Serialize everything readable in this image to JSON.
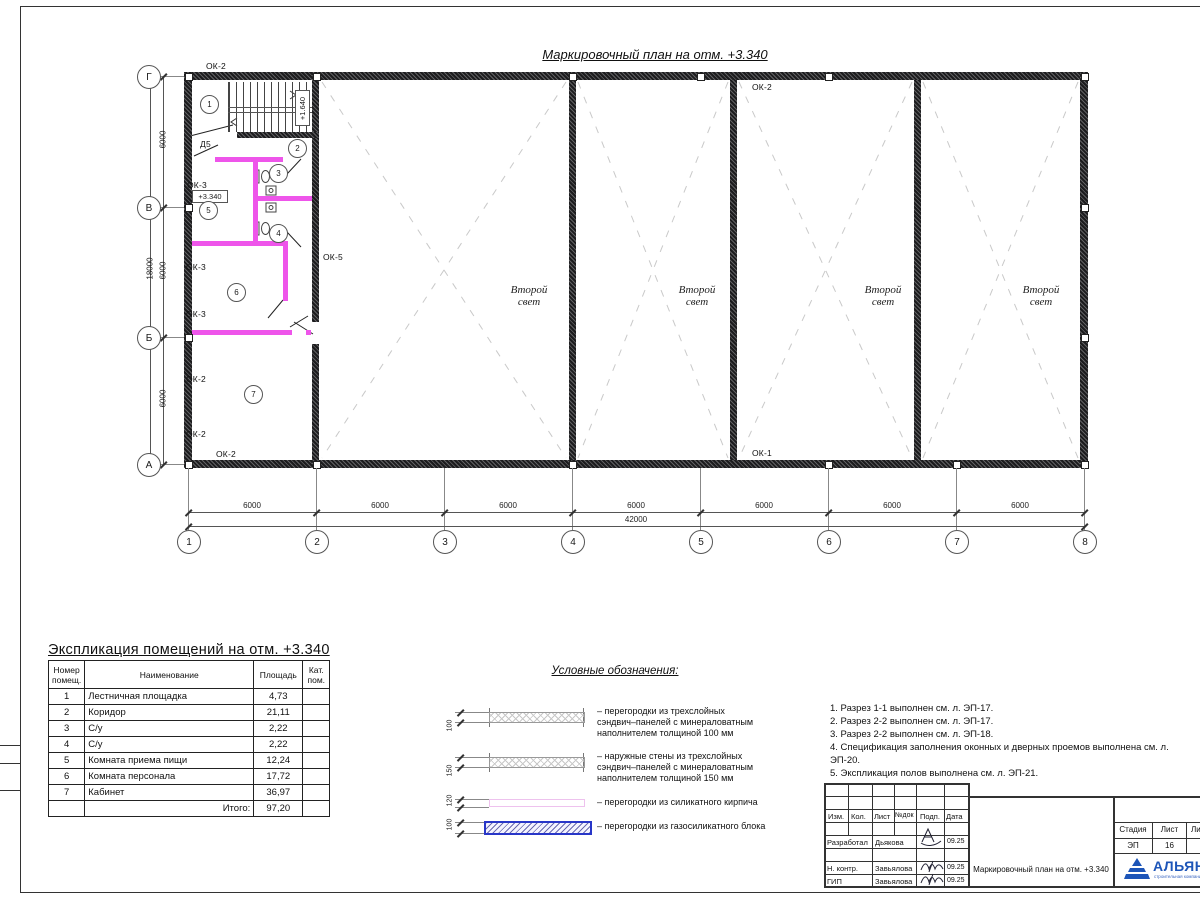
{
  "sheet_title": "Маркировочный план на отм. +3.340",
  "plan": {
    "marks": {
      "ok2_top_outside": "ОК-2",
      "ok2_top_inside": "ОК-2",
      "d5": "Д5",
      "ok3_room5": "ОК-3",
      "ok5": "ОК-5",
      "ok3_left_a": "ОК-3",
      "ok3_left_b": "ОК-3",
      "ok2_left_a": "ОК-2",
      "ok2_left_b": "ОК-2",
      "ok2_bottom": "ОК-2",
      "ok1_bottom": "ОК-1"
    },
    "levels": {
      "plan_level": "+3.340",
      "stair_level": "+1.640"
    },
    "rooms": [
      "1",
      "2",
      "3",
      "4",
      "5",
      "6",
      "7"
    ],
    "second_light": {
      "line1": "Второй",
      "line2": "свет"
    },
    "grid": {
      "cols": [
        "1",
        "2",
        "3",
        "4",
        "5",
        "6",
        "7",
        "8"
      ],
      "rows": [
        "Г",
        "В",
        "Б",
        "А"
      ]
    },
    "dims": {
      "bay": "6000",
      "total_width": "42000",
      "total_height": "18000"
    }
  },
  "room_schedule": {
    "title": "Экспликация помещений на отм. +3.340",
    "headers": {
      "num1": "Номер",
      "num2": "помещ.",
      "name": "Наименование",
      "area": "Площадь",
      "cat1": "Кат.",
      "cat2": "пом."
    },
    "rows": [
      {
        "num": "1",
        "name": "Лестничная площадка",
        "area": "4,73",
        "cat": ""
      },
      {
        "num": "2",
        "name": "Коридор",
        "area": "21,11",
        "cat": ""
      },
      {
        "num": "3",
        "name": "С/у",
        "area": "2,22",
        "cat": ""
      },
      {
        "num": "4",
        "name": "С/у",
        "area": "2,22",
        "cat": ""
      },
      {
        "num": "5",
        "name": "Комната приема пищи",
        "area": "12,24",
        "cat": ""
      },
      {
        "num": "6",
        "name": "Комната персонала",
        "area": "17,72",
        "cat": ""
      },
      {
        "num": "7",
        "name": "Кабинет",
        "area": "36,97",
        "cat": ""
      }
    ],
    "total_label": "Итого:",
    "total_value": "97,20"
  },
  "legend": {
    "title": "Условные обозначения:",
    "items": [
      {
        "thickness": "100",
        "lines": [
          "– перегородки из трехслойных",
          "сэндвич–панелей с минераловатным",
          "наполнителем толщиной 100 мм"
        ]
      },
      {
        "thickness": "150",
        "lines": [
          "– наружные стены из трехслойных",
          "сэндвич–панелей с минераловатным",
          "наполнителем толщиной 150 мм"
        ]
      },
      {
        "thickness": "120",
        "lines": [
          "– перегородки из силикатного кирпича"
        ]
      },
      {
        "thickness": "100",
        "lines": [
          "– перегородки из газосиликатного блока"
        ]
      }
    ]
  },
  "notes": [
    "1. Разрез 1-1 выполнен см. л. ЭП-17.",
    "2. Разрез 2-2 выполнен см. л. ЭП-17.",
    "3. Разрез 2-2 выполнен см. л. ЭП-18.",
    "4. Спецификация заполнения оконных и дверных проемов выполнена см. л. ЭП-20.",
    "5. Экспликация полов выполнена см. л. ЭП-21."
  ],
  "title_block": {
    "revision_header": [
      "Изм.",
      "Кол.",
      "Лист",
      "№док",
      "Подп.",
      "Дата"
    ],
    "signature_rows": [
      {
        "role": "Разработал",
        "name": "Дьякова",
        "date": "09.25"
      },
      {
        "role": "Н. контр.",
        "name": "Завьялова",
        "date": "09.25"
      },
      {
        "role": "ГИП",
        "name": "Завьялова",
        "date": "09.25"
      }
    ],
    "document_title": "Маркировочный план на отм. +3.340",
    "stage": {
      "headers": [
        "Стадия",
        "Лист",
        "Листов"
      ],
      "values": [
        "ЭП",
        "16",
        "2"
      ]
    },
    "company": {
      "name": "АЛЬЯНС",
      "tagline": "строительная компания"
    }
  }
}
